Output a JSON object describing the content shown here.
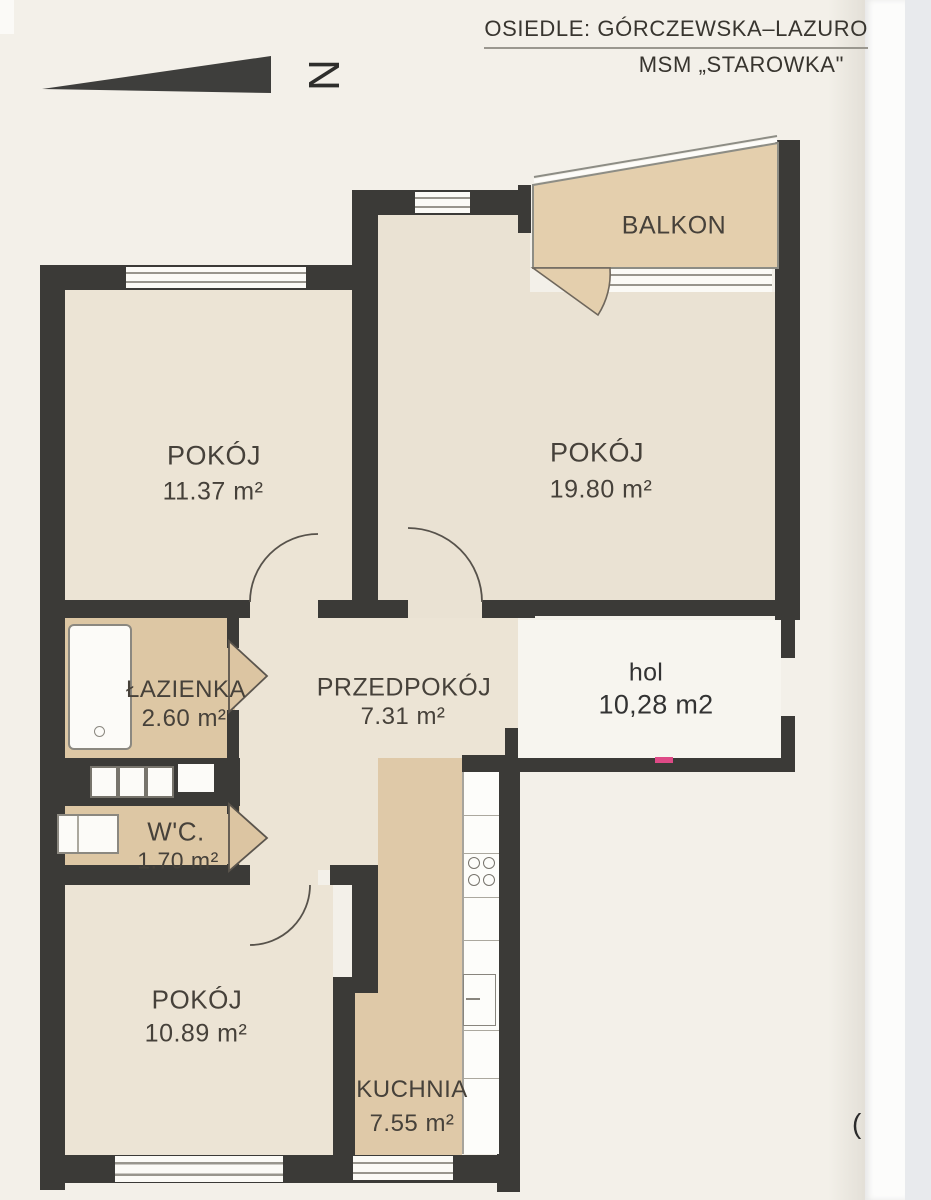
{
  "header": {
    "line1": "OSIEDLE: GÓRCZEWSKA–LAZURO",
    "line2": "MSM „STAROWKA\""
  },
  "compass": {
    "north_label": "N"
  },
  "rooms": {
    "pokoj1": {
      "name": "POKÓJ",
      "area": "11.37 m²"
    },
    "pokoj2": {
      "name": "POKÓJ",
      "area": "19.80 m²"
    },
    "balkon": {
      "name": "BALKON"
    },
    "lazienka": {
      "name": "ŁAZIENKA",
      "area": "2.60 m²"
    },
    "przedpokoj": {
      "name": "PRZEDPOKÓJ",
      "area": "7.31 m²"
    },
    "hol": {
      "name": "hol",
      "area": "10,28 m2"
    },
    "wc": {
      "name": "W'C.",
      "area": "1.70 m²"
    },
    "pokoj3": {
      "name": "POKÓJ",
      "area": "10.89 m²"
    },
    "kuchnia": {
      "name": "KUCHNIA",
      "area": "7.55 m²"
    }
  },
  "annotations": {
    "page_mark": "("
  },
  "colors": {
    "wall": "#3b3a37",
    "room_floor": "#ece4d5",
    "tan_floor": "#ddc7a4",
    "page": "#f3f0e9",
    "accent_mark": "#de4a86"
  }
}
